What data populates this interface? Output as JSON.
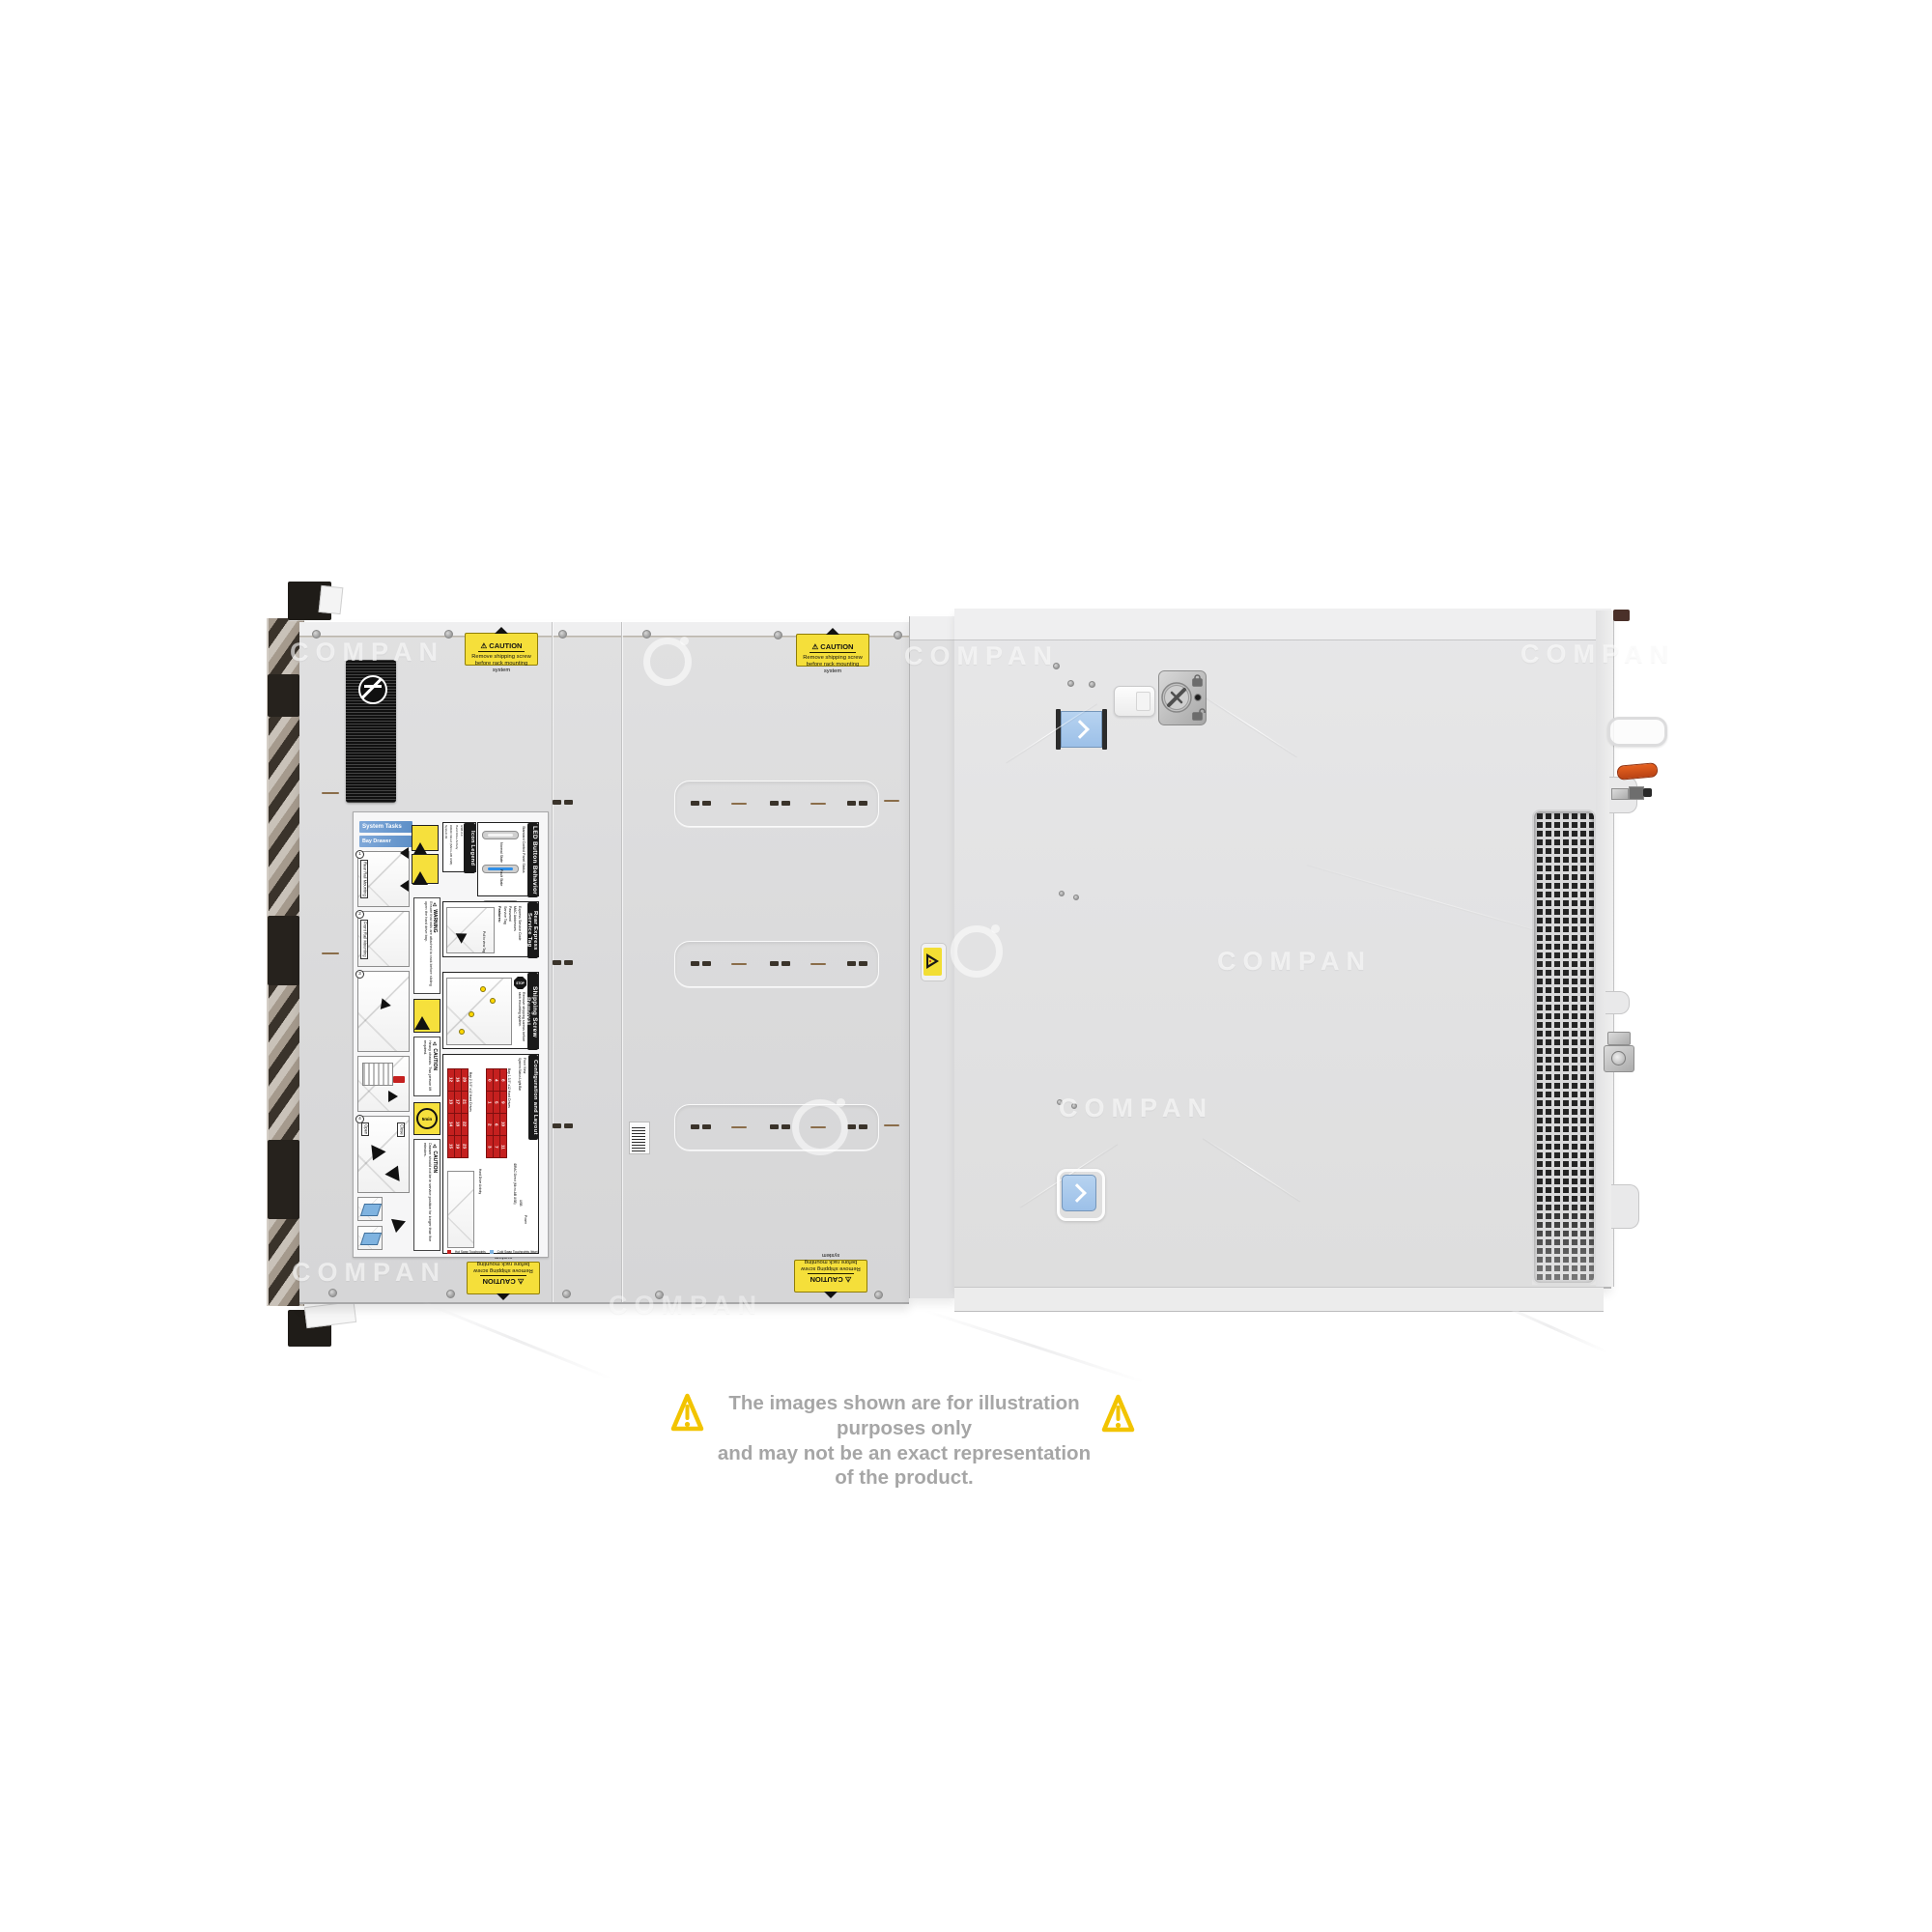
{
  "watermark": {
    "text": "COMPAN",
    "logo_icon": "ci-ring-icon"
  },
  "disclaimer": {
    "line1": "The images shown are for illustration purposes only",
    "line2": "and may not be an exact representation of the product."
  },
  "caution_label": {
    "title": "⚠ CAUTION",
    "line1": "Remove shipping screw",
    "line2": "before rack mounting system"
  },
  "service_label": {
    "system_tasks": "System Tasks",
    "bay_drawer": "Bay Drawer Operation",
    "step_numbers": [
      "1",
      "2",
      "3",
      "4"
    ],
    "step_tags": {
      "rear": "Rear Rail Mounting",
      "front": "Front Rail Mounting",
      "open": "Open",
      "close": "Close"
    },
    "warning": {
      "title": "⚠ WARNING",
      "text": "Ensure that rails are attached to rack before sliding open the hard drive bay."
    },
    "icon_legend": {
      "title": "Icon Legend",
      "items": [
        "System ID",
        "iDRAC Direct (Micro-AB USB)",
        "Hard Drive Activity",
        "USB 2.0"
      ]
    },
    "led": {
      "title": "LED Button Behavior",
      "subtitle": "Standard Control Panel Status",
      "normal": "Normal State",
      "fault": "Fault State"
    },
    "service_tag": {
      "title": "Rear Express Service Tag",
      "features_title": "Features:",
      "features": [
        "Service Tag",
        "Password",
        "MAC Addresses",
        "Express Service Code"
      ],
      "note": "Pull to view Tag"
    },
    "shipping": {
      "title": "Shipping Screw Removal",
      "stop": "STOP",
      "text": "Remove shipping screws before rack mounting system."
    },
    "caution_heavy": {
      "title": "⚠ CAUTION",
      "text": "Heavy chassis. Two person lift required."
    },
    "five_min": "5min",
    "caution_drawer": {
      "title": "⚠ CAUTION",
      "text": "Drawer should not be in service position for longer than five minutes."
    },
    "config": {
      "title": "Configuration and Layout",
      "front_view": "Front View",
      "legend_hot": "Hot Swap Touchpoints",
      "legend_cold": "Cold Swap Touchpoints (blue)",
      "bay1_label": "Bay 1 3.5\" x12 Hard Drives",
      "bay2_label": "Bay 2 3.5\" x12 Hard Drives",
      "side_labels": [
        "System Status Light Bar",
        "Hard Drive Activity",
        "iDRAC Direct (Micro-AB USB)",
        "USB",
        "Power"
      ],
      "bay1": [
        [
          "0",
          "4",
          "8"
        ],
        [
          "1",
          "5",
          "9"
        ],
        [
          "2",
          "6",
          "10"
        ],
        [
          "3",
          "7",
          "11"
        ]
      ],
      "bay2": [
        [
          "12",
          "16",
          "20"
        ],
        [
          "13",
          "17",
          "21"
        ],
        [
          "14",
          "18",
          "22"
        ],
        [
          "15",
          "19",
          "23"
        ]
      ]
    }
  },
  "stickers": {
    "middle_warning_icon": "warning-triangle-icon",
    "regulatory_icon": "no-stacking-icon",
    "barcode_icon": "barcode"
  },
  "colors": {
    "caution_yellow": "#f5df3a",
    "touchpoint_blue": "#a9c9ec",
    "lever_orange": "#d9531e",
    "led_normal": "#2f8fe8",
    "led_fault": "#f29a2e",
    "drive_red": "#c5201f",
    "header_blue": "#6fa0d6"
  }
}
